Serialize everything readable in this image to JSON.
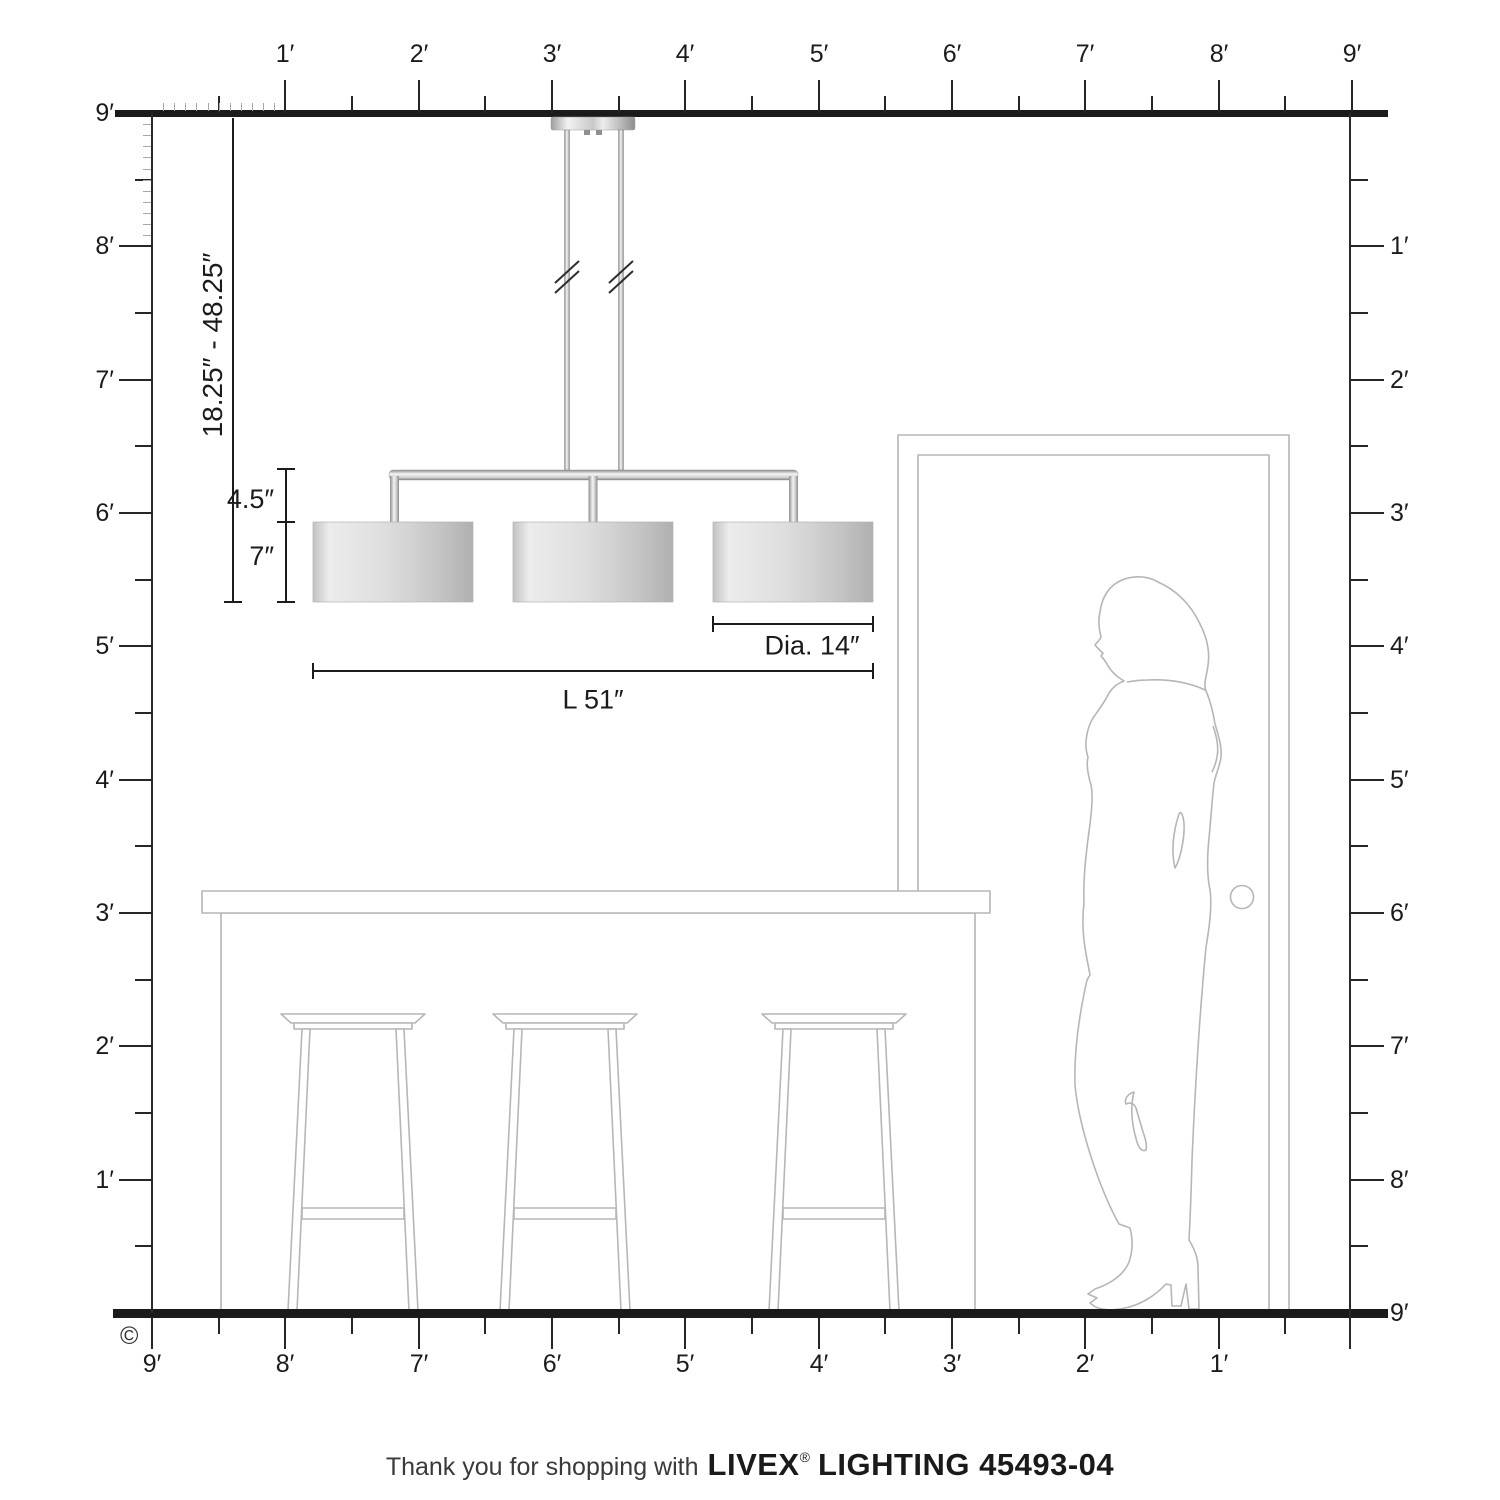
{
  "rulers": {
    "unit": "feet",
    "top": [
      "1′",
      "2′",
      "3′",
      "4′",
      "5′",
      "6′",
      "7′",
      "8′",
      "9′"
    ],
    "left": [
      "9′",
      "8′",
      "7′",
      "6′",
      "5′",
      "4′",
      "3′",
      "2′",
      "1′"
    ],
    "right": [
      "1′",
      "2′",
      "3′",
      "4′",
      "5′",
      "6′",
      "7′",
      "8′",
      "9′"
    ],
    "bottom": [
      "9′",
      "8′",
      "7′",
      "6′",
      "5′",
      "4′",
      "3′",
      "2′",
      "1′"
    ]
  },
  "dimensions": {
    "drop": "18.25″ - 48.25″",
    "frame_height": "4.5″",
    "shade_height": "7″",
    "diameter": "Dia. 14″",
    "length": "L 51″"
  },
  "footer": {
    "prefix": "Thank you for shopping with",
    "brand": "LIVEX",
    "registered": "®",
    "suffix": "LIGHTING 45493-04"
  },
  "copyright": "©",
  "colors": {
    "ink": "#1c1c1c",
    "structure": "#1b1b1b",
    "linework": "#b6b6ba",
    "shade_light": "#ececec",
    "shade_dark": "#b0b0b0",
    "metal_dark": "#8e8e8e",
    "metal_light": "#f4f4f4"
  }
}
